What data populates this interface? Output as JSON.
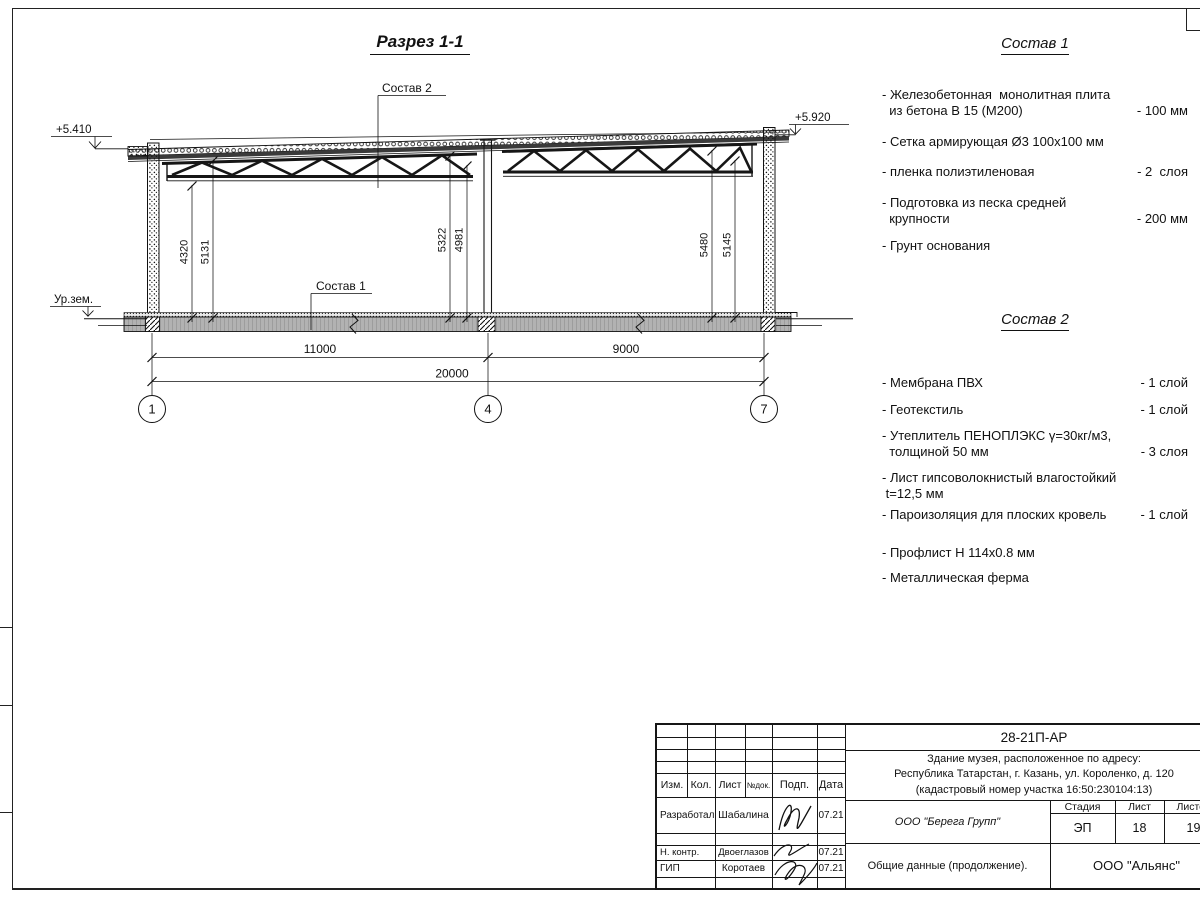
{
  "drawing": {
    "title": "Разрез 1-1",
    "leader1": "Состав 1",
    "leader2": "Состав 2",
    "elev_left": "+5.410",
    "elev_right": "+5.920",
    "ground_label": "Ур.зем.",
    "dim_v": [
      "4320",
      "5131",
      "5322",
      "4981",
      "5480",
      "5145"
    ],
    "dim_h": {
      "span1": "11000",
      "span2": "9000",
      "total": "20000"
    },
    "axes": [
      "1",
      "4",
      "7"
    ]
  },
  "sostav1": {
    "title": "Состав 1",
    "items": [
      {
        "name": "- Железобетонная  монолитная плита\n  из бетона В 15 (М200)",
        "value": "- 100 мм"
      },
      {
        "name": "- Сетка армирующая Ø3 100х100 мм",
        "value": ""
      },
      {
        "name": "- пленка полиэтиленовая",
        "value": "- 2  слоя"
      },
      {
        "name": "- Подготовка из песка средней\n  крупности",
        "value": "- 200 мм"
      },
      {
        "name": "- Грунт основания",
        "value": ""
      }
    ]
  },
  "sostav2": {
    "title": "Состав 2",
    "items": [
      {
        "name": "- Мембрана ПВХ",
        "value": "- 1 слой"
      },
      {
        "name": "- Геотекстиль",
        "value": "- 1 слой"
      },
      {
        "name": "- Утеплитель ПЕНОПЛЭКС γ=30кг/м3,\n  толщиной 50 мм",
        "value": "- 3 слоя"
      },
      {
        "name": "- Лист гипсоволокнистый влагостойкий\n t=12,5 мм",
        "value": ""
      },
      {
        "name": "- Пароизоляция для плоских кровель",
        "value": "- 1 слой"
      },
      {
        "name": "- Профлист Н 114х0.8 мм",
        "value": ""
      },
      {
        "name": "- Металлическая ферма",
        "value": ""
      }
    ]
  },
  "titleblock": {
    "doc_number": "28-21П-АР",
    "address_line1": "Здание музея, расположенное по адресу:",
    "address_line2": "Республика Татарстан, г. Казань, ул. Короленко, д. 120",
    "address_line3": "(кадастровый номер участка 16:50:230104:13)",
    "cols": [
      "Изм.",
      "Кол.",
      "Лист",
      "№док.",
      "Подп.",
      "Дата"
    ],
    "rows": [
      {
        "role": "Разработал",
        "name": "Шабалина",
        "date": "07.21"
      },
      {
        "role": "Н. контр.",
        "name": "Двоеглазов",
        "date": "07.21"
      },
      {
        "role": "ГИП",
        "name": "Коротаев",
        "date": "07.21"
      }
    ],
    "company": "ООО \"Берега Групп\"",
    "stage_label": "Стадия",
    "sheet_label": "Лист",
    "sheets_label": "Листов",
    "stage": "ЭП",
    "sheet": "18",
    "sheets": "19",
    "doc_title": "Общие данные (продолжение).",
    "contractor": "ООО \"Альянс\""
  }
}
